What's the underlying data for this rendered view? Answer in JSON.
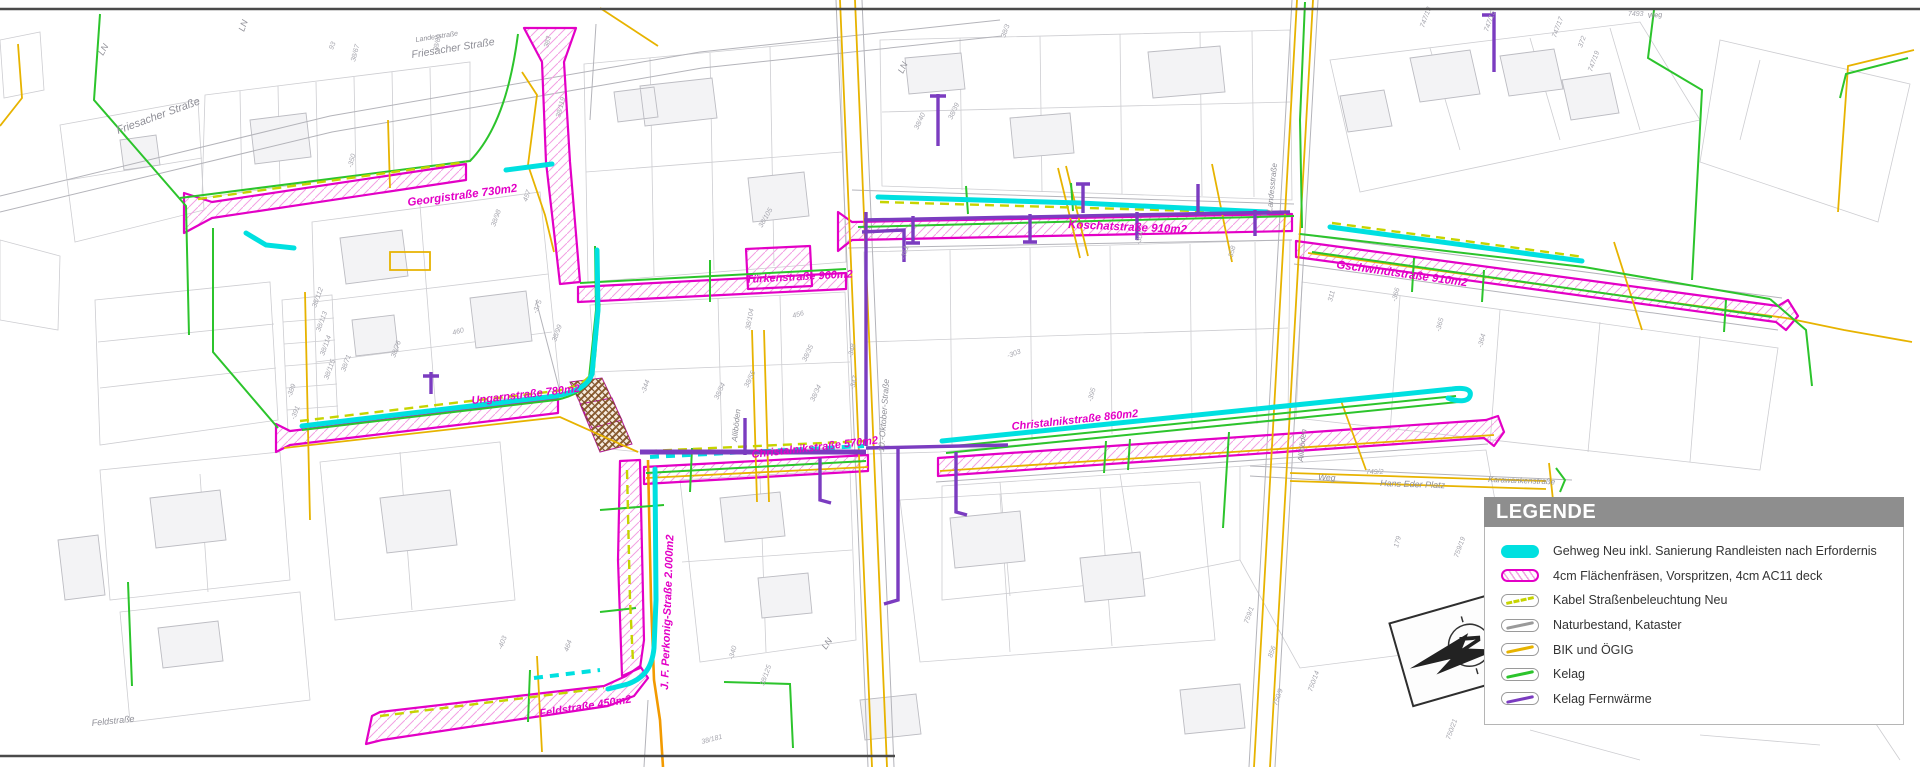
{
  "colors": {
    "gehweg": "#00e0e0",
    "fraesen": "#e300c6",
    "hatchm": "#f2a0e2",
    "kabel": "#c6d400",
    "natur": "#9a9a9a",
    "bik": "#e7b300",
    "kelag": "#2cc42c",
    "fern": "#7b3cc0",
    "legend_header": "#8e8e8e",
    "parcel_gray": "#cdcdd1"
  },
  "legend": {
    "title": "LEGENDE",
    "items": [
      {
        "swatch": "gehweg",
        "label": "Gehweg Neu inkl. Sanierung Randleisten nach Erfordernis"
      },
      {
        "swatch": "fraesen",
        "label": "4cm Flächenfräsen, Vorspritzen, 4cm AC11 deck"
      },
      {
        "swatch": "kabel",
        "label": "Kabel Straßenbeleuchtung Neu"
      },
      {
        "swatch": "natur",
        "label": "Naturbestand, Kataster"
      },
      {
        "swatch": "bik",
        "label": "BIK und ÖGIG"
      },
      {
        "swatch": "kelag",
        "label": "Kelag"
      },
      {
        "swatch": "fernwaerme",
        "label": "Kelag Fernwärme"
      }
    ]
  },
  "north": {
    "label": "N"
  },
  "street_labels": [
    {
      "t": "Georgistraße 730m2",
      "x": 408,
      "y": 206,
      "r": -7.5,
      "s": 11.5
    },
    {
      "t": "Türkenstraße 960m2",
      "x": 746,
      "y": 283,
      "r": -3,
      "s": 11
    },
    {
      "t": "Koschatstraße 910m2",
      "x": 1068,
      "y": 228,
      "r": 2.5,
      "s": 11.5
    },
    {
      "t": "Gschwindtstraße 910m2",
      "x": 1336,
      "y": 268,
      "r": 8,
      "s": 11.5
    },
    {
      "t": "Ungarnstraße 780m2",
      "x": 472,
      "y": 404,
      "r": -6.5,
      "s": 11
    },
    {
      "t": "Christalnikstraße 570m2",
      "x": 752,
      "y": 458,
      "r": -6.5,
      "s": 11
    },
    {
      "t": "Christalnikstraße 860m2",
      "x": 1012,
      "y": 430,
      "r": -6,
      "s": 11
    },
    {
      "t": "Feldstraße 450m2",
      "x": 540,
      "y": 717,
      "r": -9,
      "s": 11
    },
    {
      "t": "J. F. Perkonig-Straße 2.000m2",
      "x": 668,
      "y": 690,
      "r": -88,
      "s": 11
    }
  ],
  "map_labels": [
    {
      "t": "Friesacher Straße",
      "x": 118,
      "y": 134,
      "r": -20,
      "s": 11
    },
    {
      "t": "Landesstraße",
      "x": 416,
      "y": 42,
      "r": -9,
      "s": 7
    },
    {
      "t": "Friesacher Straße",
      "x": 412,
      "y": 58,
      "r": -9,
      "s": 10.5
    },
    {
      "t": "Weg",
      "x": 1318,
      "y": 480,
      "r": 2,
      "s": 8.5
    },
    {
      "t": "Hans Eder Platz",
      "x": 1380,
      "y": 486,
      "r": 2,
      "s": 9
    },
    {
      "t": "Karawankenstraße",
      "x": 1488,
      "y": 482,
      "r": 2,
      "s": 8
    },
    {
      "t": "10.-Oktober-Straße",
      "x": 884,
      "y": 452,
      "r": -86,
      "s": 8.5
    },
    {
      "t": "Landesstraße",
      "x": 1272,
      "y": 212,
      "r": -84,
      "s": 8
    },
    {
      "t": "Alliböden",
      "x": 737,
      "y": 442,
      "r": -84,
      "s": 8
    },
    {
      "t": "Alliböden",
      "x": 1303,
      "y": 462,
      "r": -84,
      "s": 8
    },
    {
      "t": "Feldstraße",
      "x": 92,
      "y": 726,
      "r": -6,
      "s": 9
    },
    {
      "t": "Weg",
      "x": 1648,
      "y": 18,
      "r": -5,
      "s": 7
    },
    {
      "t": "LN",
      "x": 103,
      "y": 56,
      "r": -60,
      "s": 9
    },
    {
      "t": "LN",
      "x": 244,
      "y": 32,
      "r": -70,
      "s": 9
    },
    {
      "t": "LN",
      "x": 903,
      "y": 74,
      "r": -65,
      "s": 9
    },
    {
      "t": "LN",
      "x": 826,
      "y": 650,
      "r": -55,
      "s": 9
    }
  ],
  "parcel_labels": [
    {
      "t": "38/67",
      "x": 355,
      "y": 62,
      "r": -75
    },
    {
      "t": "38/69",
      "x": 437,
      "y": 52,
      "r": -75
    },
    {
      "t": "38/119",
      "x": 560,
      "y": 118,
      "r": -75
    },
    {
      "t": "383",
      "x": 548,
      "y": 48,
      "r": -75
    },
    {
      "t": "-350",
      "x": 352,
      "y": 168,
      "r": -75
    },
    {
      "t": "38/71",
      "x": 345,
      "y": 372,
      "r": -70
    },
    {
      "t": "38/112",
      "x": 316,
      "y": 308,
      "r": -70
    },
    {
      "t": "38/113",
      "x": 320,
      "y": 332,
      "r": -70
    },
    {
      "t": "38/114",
      "x": 324,
      "y": 356,
      "r": -70
    },
    {
      "t": "38/115",
      "x": 328,
      "y": 380,
      "r": -70
    },
    {
      "t": "-389",
      "x": 291,
      "y": 398,
      "r": -70
    },
    {
      "t": "-391",
      "x": 295,
      "y": 420,
      "r": -70
    },
    {
      "t": "38/76",
      "x": 395,
      "y": 358,
      "r": -70
    },
    {
      "t": "460",
      "x": 453,
      "y": 335,
      "r": -15
    },
    {
      "t": "-375",
      "x": 537,
      "y": 314,
      "r": -70
    },
    {
      "t": "38/99",
      "x": 556,
      "y": 342,
      "r": -70
    },
    {
      "t": "38/98",
      "x": 495,
      "y": 227,
      "r": -70
    },
    {
      "t": "457",
      "x": 527,
      "y": 202,
      "r": -70
    },
    {
      "t": "-344",
      "x": 645,
      "y": 394,
      "r": -70
    },
    {
      "t": "38/54",
      "x": 718,
      "y": 400,
      "r": -65
    },
    {
      "t": "38/55",
      "x": 748,
      "y": 388,
      "r": -65
    },
    {
      "t": "38/35",
      "x": 806,
      "y": 362,
      "r": -65
    },
    {
      "t": "38/34",
      "x": 814,
      "y": 402,
      "r": -65
    },
    {
      "t": "-348",
      "x": 852,
      "y": 358,
      "r": -75
    },
    {
      "t": "-347",
      "x": 854,
      "y": 390,
      "r": -75
    },
    {
      "t": "38/105",
      "x": 762,
      "y": 228,
      "r": -60
    },
    {
      "t": "38/104",
      "x": 750,
      "y": 330,
      "r": -80
    },
    {
      "t": "456",
      "x": 793,
      "y": 318,
      "r": -15
    },
    {
      "t": "-351",
      "x": 905,
      "y": 260,
      "r": -75
    },
    {
      "t": "38/39",
      "x": 952,
      "y": 120,
      "r": -65
    },
    {
      "t": "38/40",
      "x": 918,
      "y": 130,
      "r": -65
    },
    {
      "t": "-303",
      "x": 1008,
      "y": 358,
      "r": -20
    },
    {
      "t": "-395",
      "x": 1092,
      "y": 402,
      "r": -75
    },
    {
      "t": "-358",
      "x": 1232,
      "y": 260,
      "r": -75
    },
    {
      "t": "-304",
      "x": 1140,
      "y": 245,
      "r": -75
    },
    {
      "t": "311",
      "x": 1332,
      "y": 302,
      "r": -75
    },
    {
      "t": "-366",
      "x": 1396,
      "y": 302,
      "r": -75
    },
    {
      "t": "-364",
      "x": 1482,
      "y": 348,
      "r": -75
    },
    {
      "t": "-365",
      "x": 1440,
      "y": 332,
      "r": -75
    },
    {
      "t": "747/13",
      "x": 1424,
      "y": 28,
      "r": -70
    },
    {
      "t": "747/15",
      "x": 1488,
      "y": 32,
      "r": -70
    },
    {
      "t": "747/17",
      "x": 1556,
      "y": 38,
      "r": -70
    },
    {
      "t": "747/19",
      "x": 1592,
      "y": 72,
      "r": -70
    },
    {
      "t": "7493",
      "x": 1628,
      "y": 16,
      "r": 0
    },
    {
      "t": "372",
      "x": 1582,
      "y": 48,
      "r": -70
    },
    {
      "t": "749/2",
      "x": 1366,
      "y": 474,
      "r": 0
    },
    {
      "t": "179",
      "x": 1398,
      "y": 548,
      "r": -75
    },
    {
      "t": "759/19",
      "x": 1458,
      "y": 558,
      "r": -70
    },
    {
      "t": "856",
      "x": 1272,
      "y": 658,
      "r": -70
    },
    {
      "t": "750/14",
      "x": 1312,
      "y": 692,
      "r": -70
    },
    {
      "t": "750/9",
      "x": 1277,
      "y": 706,
      "r": -70
    },
    {
      "t": "750/21",
      "x": 1450,
      "y": 740,
      "r": -70
    },
    {
      "t": "759/1",
      "x": 1248,
      "y": 624,
      "r": -70
    },
    {
      "t": "-340",
      "x": 733,
      "y": 660,
      "r": -75
    },
    {
      "t": "38/125",
      "x": 764,
      "y": 686,
      "r": -70
    },
    {
      "t": "38/181",
      "x": 702,
      "y": 744,
      "r": -15
    },
    {
      "t": "464",
      "x": 568,
      "y": 652,
      "r": -70
    },
    {
      "t": "-403",
      "x": 502,
      "y": 650,
      "r": -70
    },
    {
      "t": "93",
      "x": 333,
      "y": 50,
      "r": -70
    },
    {
      "t": "38/3",
      "x": 1005,
      "y": 38,
      "r": -70
    }
  ]
}
